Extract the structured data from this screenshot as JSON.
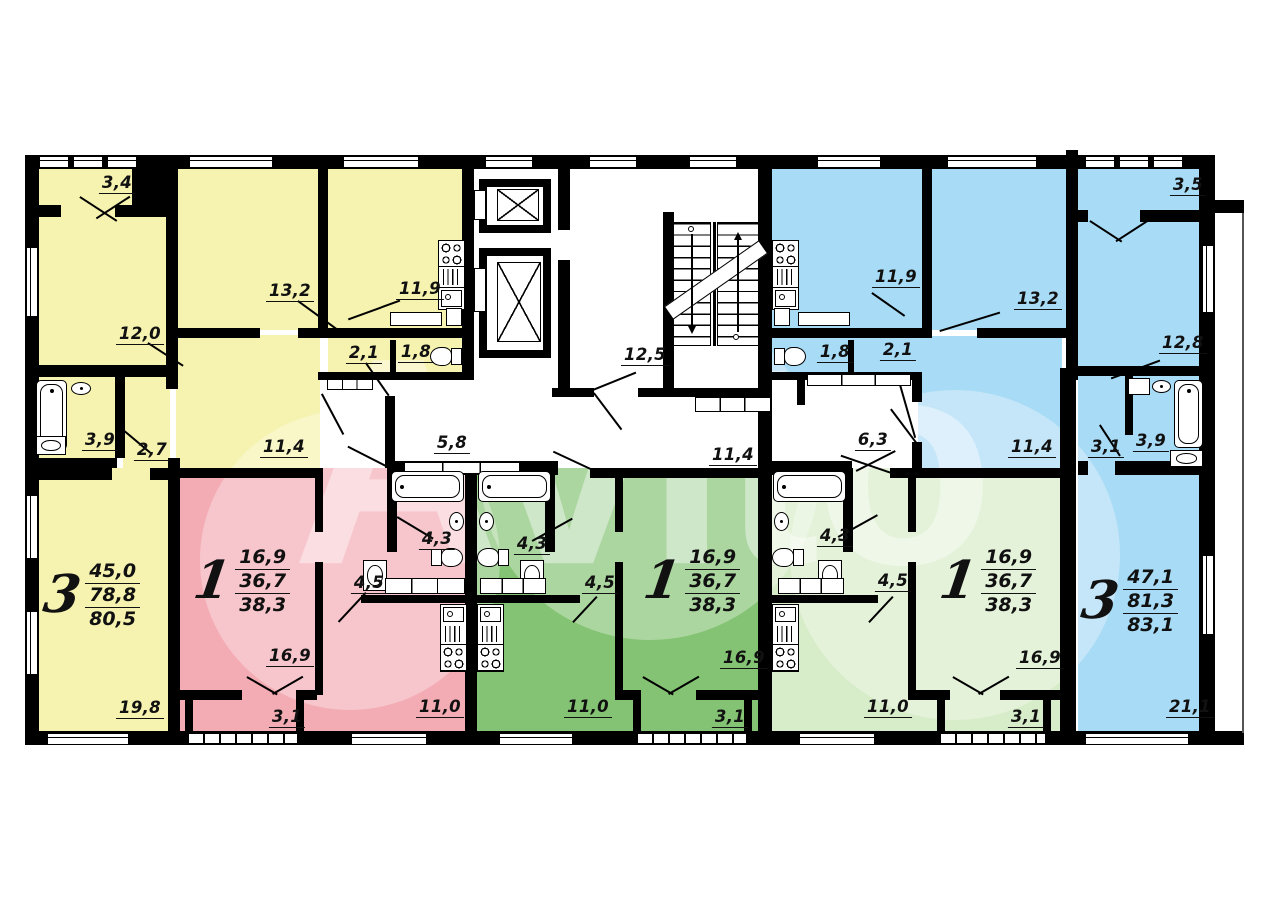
{
  "watermark": {
    "text": "Avito"
  },
  "colors": {
    "yellow": "#f6f2af",
    "pink": "#f3acb4",
    "green": "#83c373",
    "lightgreen": "#d7ecc8",
    "blue": "#a8dbf5"
  },
  "common": {
    "stair_hall": "12,5",
    "entry_hall_left": "5,8",
    "corridor": "11,4",
    "entry_hall_right": "6,3"
  },
  "apartments": {
    "left_3room": {
      "type": "3",
      "living_area": "45,0",
      "usable_area": "78,8",
      "total_area": "80,5",
      "rooms": {
        "balcony": "3,4",
        "bedroom": "12,0",
        "bedroom2": "13,2",
        "kitchen": "11,9",
        "storage": "2,1",
        "wc": "1,8",
        "bathroom": "3,9",
        "hallway": "2,7",
        "hall": "11,4",
        "living_room": "19,8"
      }
    },
    "pink_1room": {
      "type": "1",
      "living_area": "16,9",
      "usable_area": "36,7",
      "total_area": "38,3",
      "rooms": {
        "bathroom": "4,3",
        "hall": "4,5",
        "living_room": "16,9",
        "balcony": "3,1",
        "kitchen": "11,0"
      }
    },
    "green_1room": {
      "type": "1",
      "living_area": "16,9",
      "usable_area": "36,7",
      "total_area": "38,3",
      "rooms": {
        "bathroom": "4,3",
        "hall": "4,5",
        "living_room": "16,9",
        "balcony": "3,1",
        "kitchen": "11,0"
      }
    },
    "lightgreen_1room": {
      "type": "1",
      "living_area": "16,9",
      "usable_area": "36,7",
      "total_area": "38,3",
      "rooms": {
        "bathroom": "4,3",
        "hall": "4,5",
        "living_room": "16,9",
        "balcony": "3,1",
        "kitchen": "11,0"
      }
    },
    "right_3room": {
      "type": "3",
      "living_area": "47,1",
      "usable_area": "81,3",
      "total_area": "83,1",
      "rooms": {
        "balcony": "3,5",
        "kitchen": "11,9",
        "bedroom": "13,2",
        "bedroom2": "12,8",
        "wc": "1,8",
        "storage": "2,1",
        "hall": "11,4",
        "hallway": "3,1",
        "bathroom": "3,9",
        "living_room": "21,1"
      }
    }
  }
}
